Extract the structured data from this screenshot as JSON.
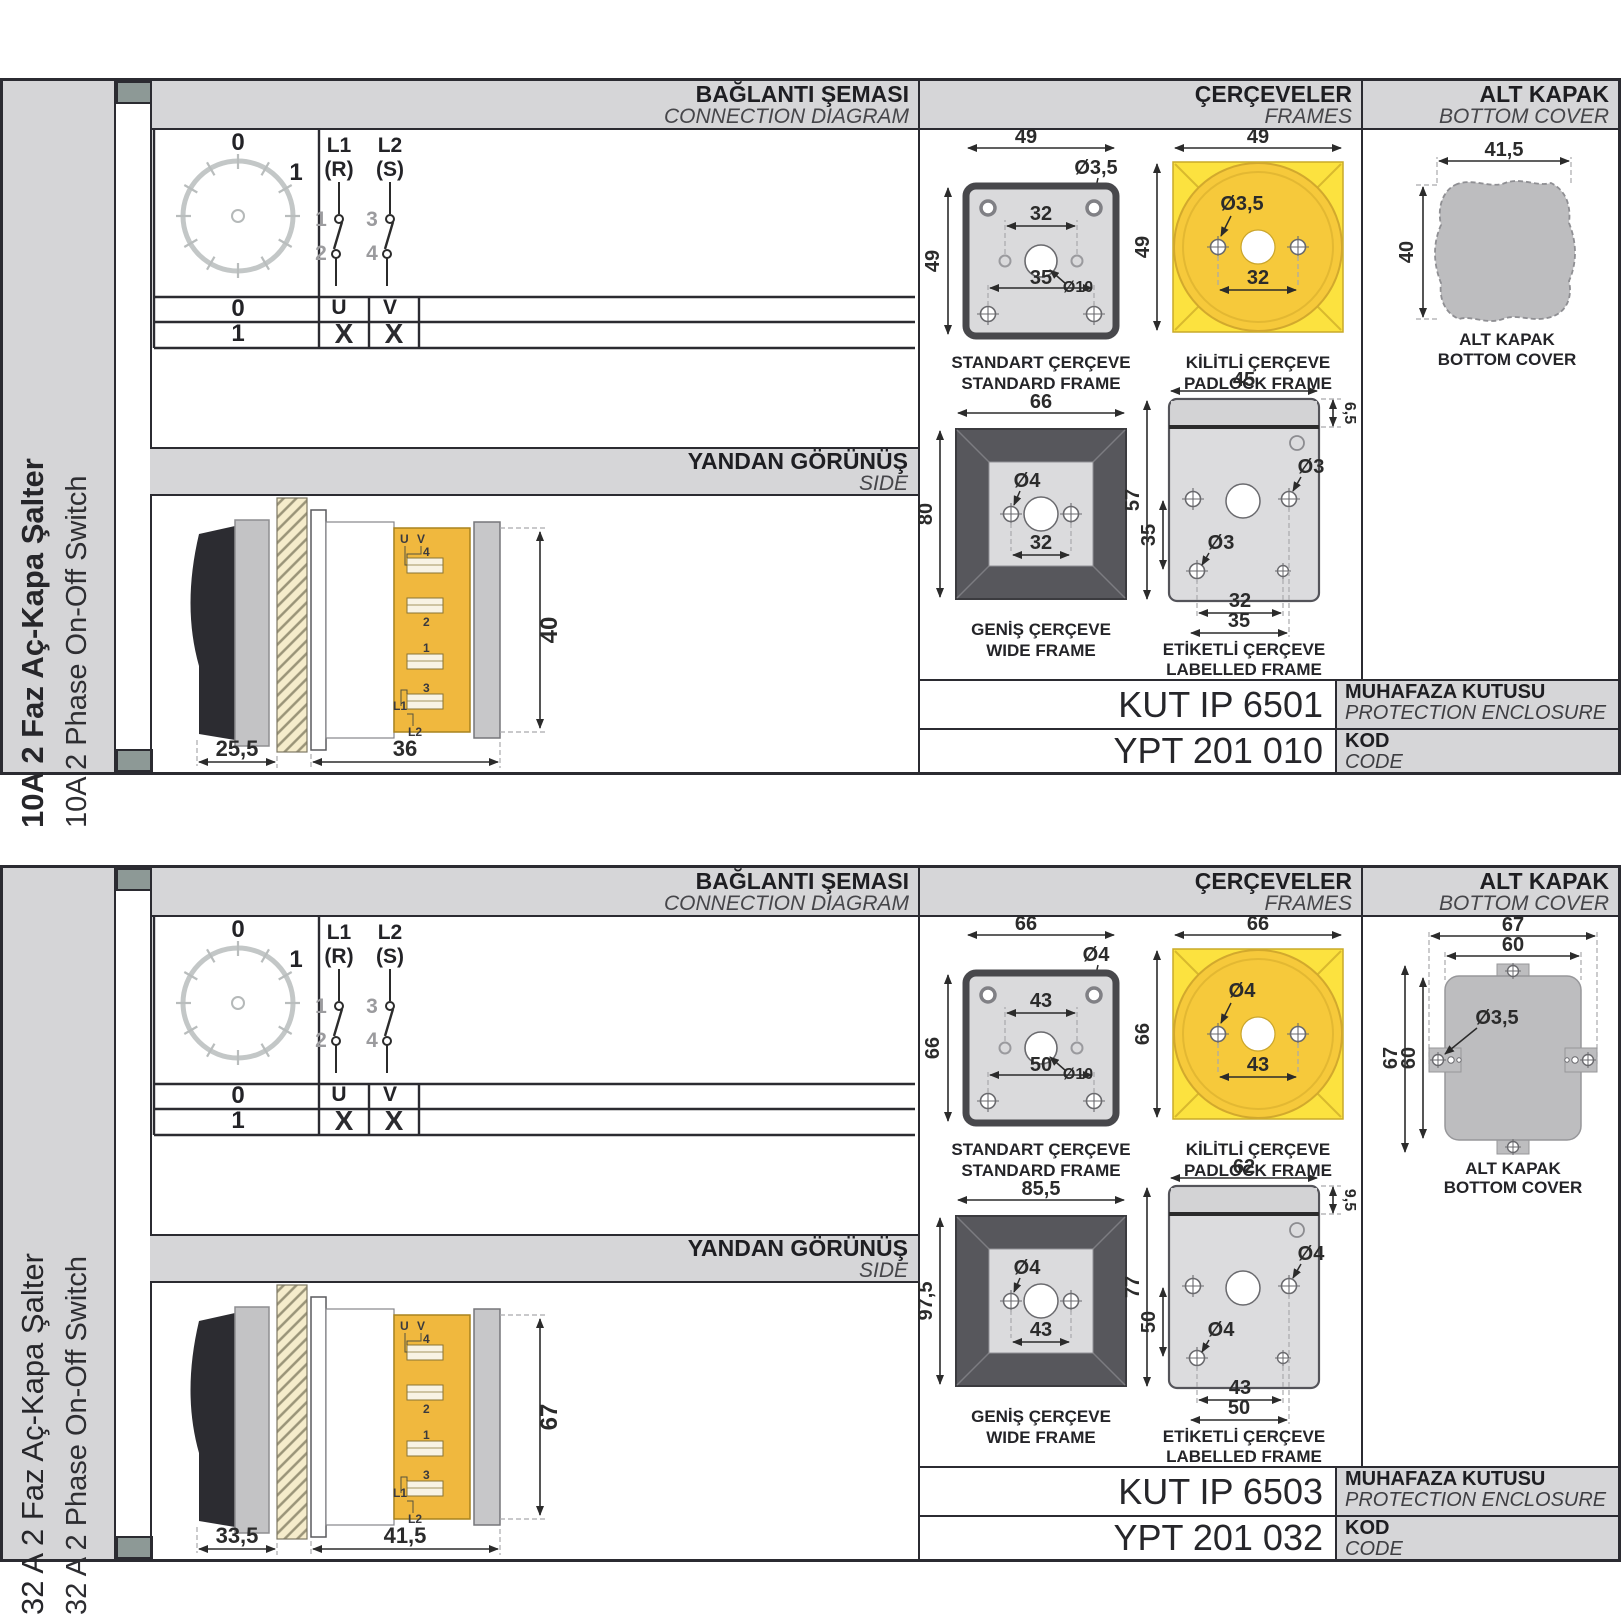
{
  "sections": [
    {
      "sidebar": {
        "title": "10A 2 Faz Aç-Kapa Şalter",
        "subtitle": "10A 2 Phase On-Off Switch"
      },
      "headers": {
        "connection_tr": "BAĞLANTI ŞEMASI",
        "connection_en": "CONNECTION DIAGRAM",
        "frames_tr": "ÇERÇEVELER",
        "frames_en": "FRAMES",
        "cover_tr": "ALT KAPAK",
        "cover_en": "BOTTOM COVER",
        "side_tr": "YANDAN GÖRÜNÜŞ",
        "side_en": "SIDE"
      },
      "diagram": {
        "pos_top": "0",
        "pos_right": "1",
        "l1": "L1",
        "l1_phase": "(R)",
        "l2": "L2",
        "l2_phase": "(S)",
        "n1": "1",
        "n2": "2",
        "n3": "3",
        "n4": "4",
        "out1": "U",
        "out2": "V",
        "rows": [
          {
            "pos": "0",
            "u": "",
            "v": ""
          },
          {
            "pos": "1",
            "u": "X",
            "v": "X"
          }
        ]
      },
      "side_view": {
        "dim_depth_front": "25,5",
        "dim_depth_body": "36",
        "dim_height": "40",
        "labels": {
          "u": "U",
          "v": "V",
          "t4": "4",
          "t2": "2",
          "t1": "1",
          "t3": "3",
          "l1": "L1",
          "l2": "L2"
        }
      },
      "frames": {
        "standard": {
          "cap1": "STANDART ÇERÇEVE",
          "cap2": "STANDARD FRAME",
          "w": "49",
          "h": "49",
          "hole": "Ø3,5",
          "pitch": "32",
          "center": "Ø10",
          "pitch2": "35"
        },
        "padlock": {
          "cap1": "KİLİTLİ ÇERÇEVE",
          "cap2": "PADLOCK FRAME",
          "w": "49",
          "h": "49",
          "hole": "Ø3,5",
          "pitch": "32"
        },
        "wide": {
          "cap1": "GENİŞ ÇERÇEVE",
          "cap2": "WIDE FRAME",
          "w": "66",
          "h": "80",
          "hole": "Ø4",
          "pitch": "32"
        },
        "labelled": {
          "cap1": "ETİKETLİ ÇERÇEVE",
          "cap2": "LABELLED FRAME",
          "w": "45",
          "strip": "6,5",
          "h": "57",
          "h_inner": "35",
          "hole_left": "Ø3",
          "hole_right": "Ø3",
          "pitch": "32",
          "pitch2": "35"
        }
      },
      "cover": {
        "cap1": "ALT KAPAK",
        "cap2": "BOTTOM COVER",
        "w": "41,5",
        "h": "40"
      },
      "codes": {
        "enclosure_value": "KUT IP 6501",
        "enclosure_tr": "MUHAFAZA KUTUSU",
        "enclosure_en": "PROTECTION ENCLOSURE",
        "code_value": "YPT 201 010",
        "code_tr": "KOD",
        "code_en": "CODE"
      }
    },
    {
      "sidebar": {
        "title": "32 A 2 Faz Aç-Kapa Şalter",
        "subtitle": "32 A 2 Phase On-Off Switch"
      },
      "headers": {
        "connection_tr": "BAĞLANTI ŞEMASI",
        "connection_en": "CONNECTION DIAGRAM",
        "frames_tr": "ÇERÇEVELER",
        "frames_en": "FRAMES",
        "cover_tr": "ALT KAPAK",
        "cover_en": "BOTTOM COVER",
        "side_tr": "YANDAN GÖRÜNÜŞ",
        "side_en": "SIDE"
      },
      "diagram": {
        "pos_top": "0",
        "pos_right": "1",
        "l1": "L1",
        "l1_phase": "(R)",
        "l2": "L2",
        "l2_phase": "(S)",
        "n1": "1",
        "n2": "2",
        "n3": "3",
        "n4": "4",
        "out1": "U",
        "out2": "V",
        "rows": [
          {
            "pos": "0",
            "u": "",
            "v": ""
          },
          {
            "pos": "1",
            "u": "X",
            "v": "X"
          }
        ]
      },
      "side_view": {
        "dim_depth_front": "33,5",
        "dim_depth_body": "41,5",
        "dim_height": "67",
        "labels": {
          "u": "U",
          "v": "V",
          "t4": "4",
          "t2": "2",
          "t1": "1",
          "t3": "3",
          "l1": "L1",
          "l2": "L2"
        }
      },
      "frames": {
        "standard": {
          "cap1": "STANDART ÇERÇEVE",
          "cap2": "STANDARD FRAME",
          "w": "66",
          "h": "66",
          "hole": "Ø4",
          "pitch": "43",
          "center": "Ø10",
          "pitch2": "50"
        },
        "padlock": {
          "cap1": "KİLİTLİ ÇERÇEVE",
          "cap2": "PADLOCK FRAME",
          "w": "66",
          "h": "66",
          "hole": "Ø4",
          "pitch": "43"
        },
        "wide": {
          "cap1": "GENİŞ ÇERÇEVE",
          "cap2": "WIDE FRAME",
          "w": "85,5",
          "h": "97,5",
          "hole": "Ø4",
          "pitch": "43"
        },
        "labelled": {
          "cap1": "ETİKETLİ ÇERÇEVE",
          "cap2": "LABELLED FRAME",
          "w": "62",
          "strip": "9,5",
          "h": "77",
          "h_inner": "50",
          "hole_left": "Ø4",
          "hole_right": "Ø4",
          "pitch": "43",
          "pitch2": "50"
        }
      },
      "cover": {
        "cap1": "ALT KAPAK",
        "cap2": "BOTTOM COVER",
        "w": "67",
        "w2": "60",
        "h": "67",
        "h2": "60",
        "hole": "Ø3,5"
      },
      "codes": {
        "enclosure_value": "KUT IP 6503",
        "enclosure_tr": "MUHAFAZA KUTUSU",
        "enclosure_en": "PROTECTION ENCLOSURE",
        "code_value": "YPT 201 032",
        "code_tr": "KOD",
        "code_en": "CODE"
      }
    }
  ]
}
